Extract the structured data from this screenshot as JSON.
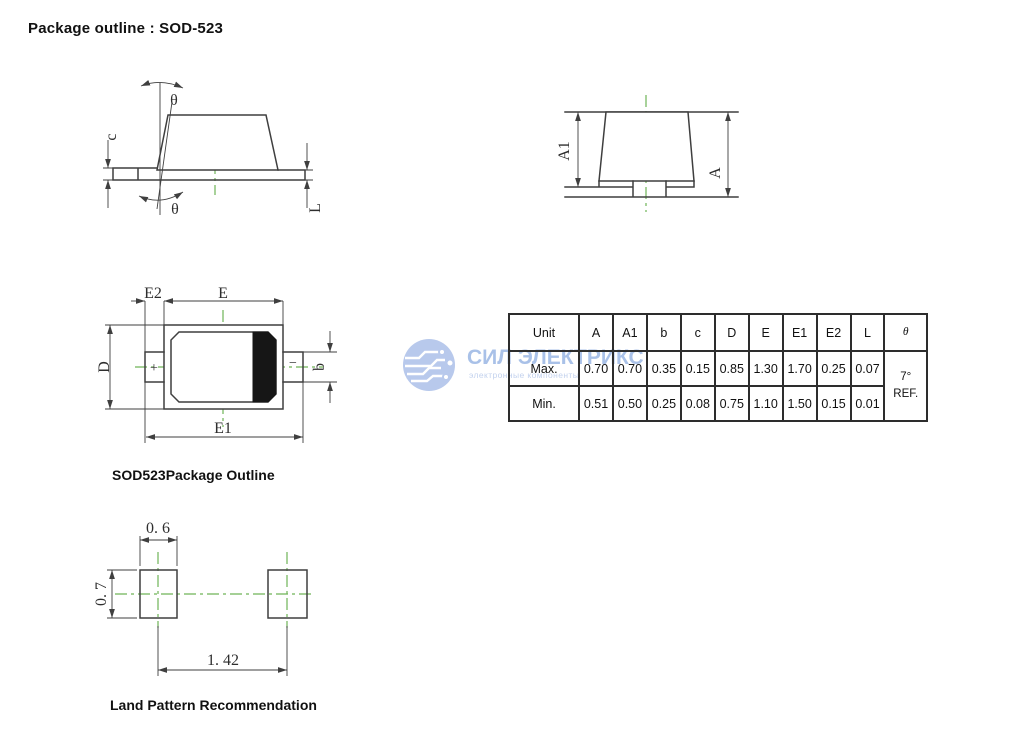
{
  "page": {
    "title": "Package outline : SOD-523"
  },
  "captions": {
    "package_outline": "SOD523Package Outline",
    "land_pattern": "Land Pattern Recommendation"
  },
  "side_view": {
    "theta_top": "θ",
    "theta_bottom": "θ",
    "c": "c",
    "L": "L"
  },
  "front_view": {
    "A1": "A1",
    "A": "A"
  },
  "top_view": {
    "E2": "E2",
    "E": "E",
    "D": "D",
    "b": "b",
    "E1": "E1",
    "plus": "+",
    "minus": "−"
  },
  "land_pattern": {
    "pad_width": "0. 6",
    "pad_height": "0. 7",
    "pitch": "1. 42"
  },
  "table": {
    "headers": [
      "Unit",
      "A",
      "A1",
      "b",
      "c",
      "D",
      "E",
      "E1",
      "E2",
      "L",
      "θ"
    ],
    "rows": [
      {
        "label": "Max.",
        "values": [
          "0.70",
          "0.70",
          "0.35",
          "0.15",
          "0.85",
          "1.30",
          "1.70",
          "0.25",
          "0.07"
        ]
      },
      {
        "label": "Min.",
        "values": [
          "0.51",
          "0.50",
          "0.25",
          "0.08",
          "0.75",
          "1.10",
          "1.50",
          "0.15",
          "0.01"
        ]
      }
    ],
    "theta_value": "7°",
    "theta_ref": "REF."
  },
  "watermark": {
    "brand": "СИЛ ЭЛЕКТРИКС",
    "tagline": "электронные компоненты"
  },
  "colors": {
    "line": "#3f3f3f",
    "centerline": "#6fb557",
    "watermark_text": "#a9c1e8",
    "band": "#161616"
  }
}
